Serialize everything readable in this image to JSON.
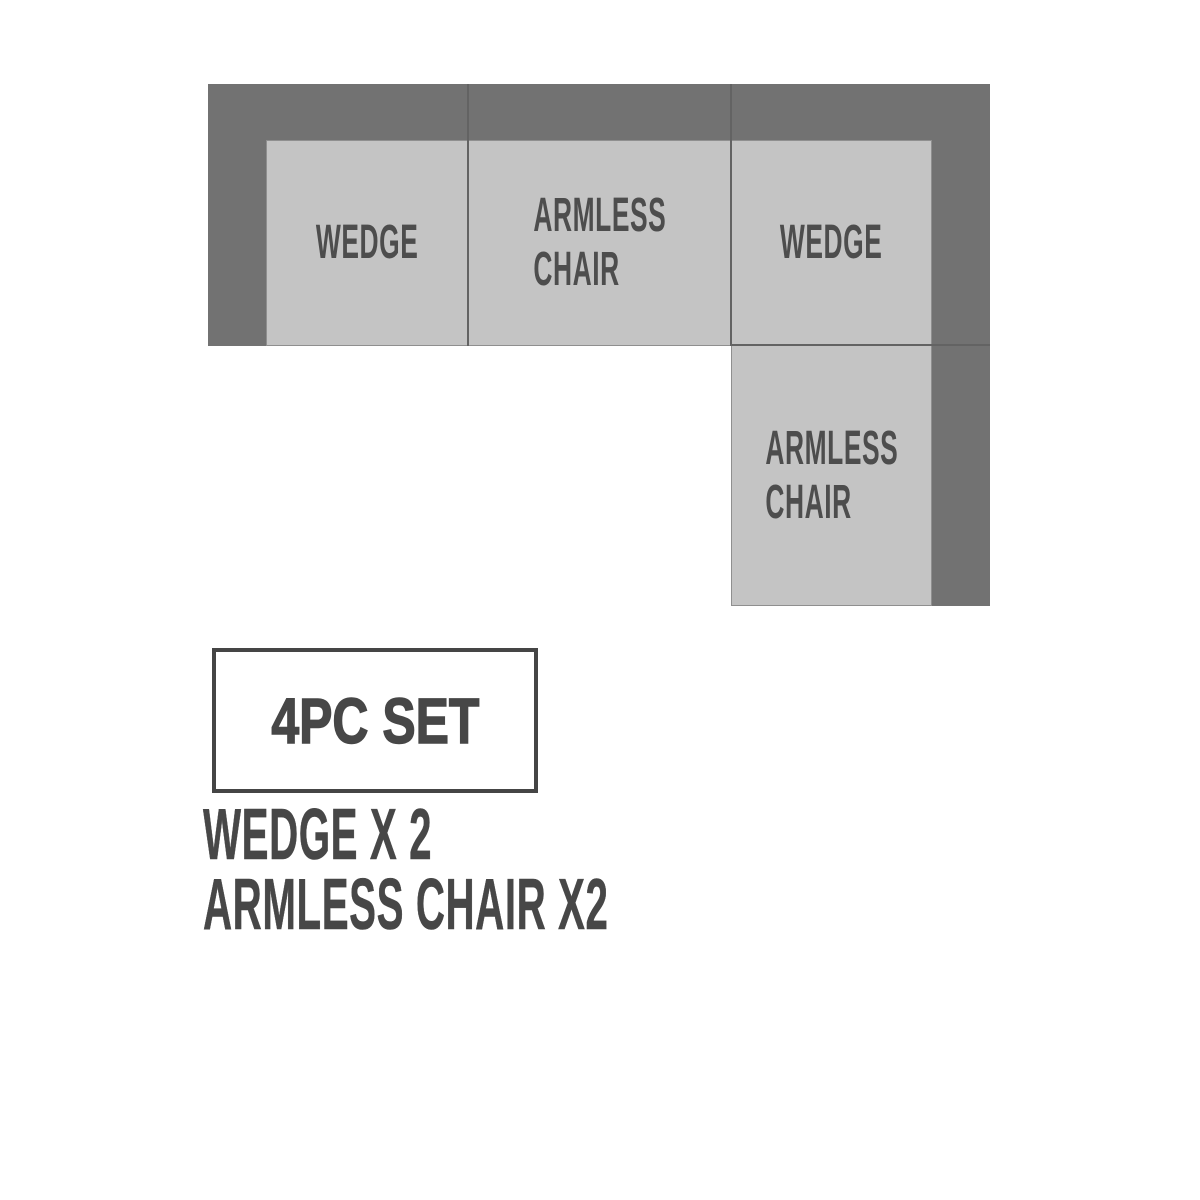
{
  "diagram": {
    "pieces": [
      {
        "id": "wedge-left",
        "lines": [
          "WEDGE"
        ]
      },
      {
        "id": "armless-chair-top",
        "lines": [
          "ARMLESS",
          "CHAIR"
        ]
      },
      {
        "id": "wedge-right",
        "lines": [
          "WEDGE"
        ]
      },
      {
        "id": "armless-chair-side",
        "lines": [
          "ARMLESS",
          "CHAIR"
        ]
      }
    ]
  },
  "badge": {
    "label": "4PC SET"
  },
  "legend": {
    "lines": [
      "WEDGE X 2",
      "ARMLESS CHAIR X2"
    ]
  },
  "colors": {
    "bg": "#ffffff",
    "frame": "#727272",
    "cushion": "#c4c4c4",
    "cushionBorder": "#8f8f8f",
    "seam": "#636363",
    "label": "#4d4d4d",
    "heavy": "#474747",
    "badgeBorder": "#454545"
  }
}
